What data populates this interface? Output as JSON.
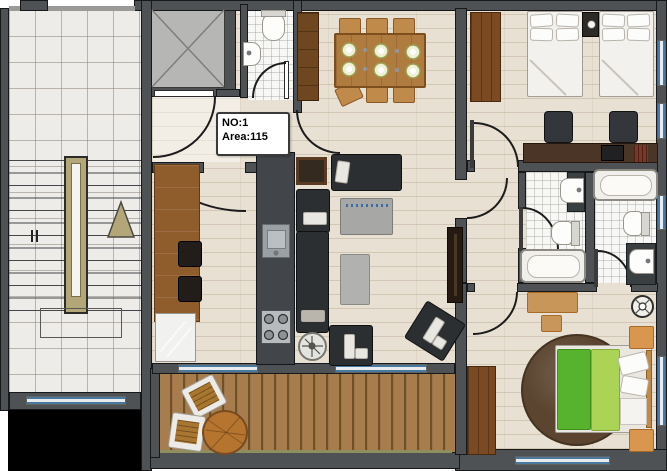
{
  "unit_label": {
    "no": "NO:1",
    "area": "Area:115"
  },
  "unit": {
    "number": "1",
    "area_value": "115"
  },
  "plan": {
    "type": "apartment-floor-plan",
    "rooms": [
      "stairwell",
      "elevator",
      "entry-hall",
      "wc",
      "kitchen",
      "dining-area",
      "living-room",
      "corridor",
      "twin-bedroom",
      "bathroom",
      "ensuite-bathroom",
      "master-bedroom",
      "balcony"
    ],
    "furniture": [
      "dining-table-with-6-chairs",
      "tall-cabinet",
      "kitchen-counter",
      "bar-stools",
      "fridge",
      "kitchen-island",
      "kitchen-sink",
      "stove",
      "sofa-set",
      "coffee-table",
      "ottoman",
      "armchairs",
      "side-table",
      "tv-cabinet",
      "wall-art",
      "twin-beds",
      "nightstand-with-clock",
      "study-desk",
      "desk-chairs",
      "laptop",
      "books",
      "wardrobes",
      "bathtubs",
      "toilets",
      "wash-basins",
      "double-bed",
      "green-duvet",
      "round-rug",
      "floor-lamp",
      "nightstands",
      "balcony-round-table",
      "balcony-chairs",
      "staircase-up-arrow"
    ]
  },
  "colors": {
    "wall": "#4f5254",
    "wood_floor": "#e8e0d2",
    "marble": "#edece8",
    "tile": "#f7f7f5",
    "deck": "#a87d4e",
    "window_glass": "#49799e",
    "counter_wood": "#8f5d2c",
    "cabinet_wood": "#6e4620",
    "sofa": "#2c2f31",
    "coffee_table": "#a7a7a5",
    "bed_linen": "#f2f1ee",
    "duvet_green_dark": "#57b32e",
    "duvet_green_light": "#abd355",
    "nightstand": "#d9964f",
    "rug": "#5b4530",
    "stair_railing": "#b3a679",
    "label_bg": "#ffffff",
    "label_text": "#000000"
  }
}
